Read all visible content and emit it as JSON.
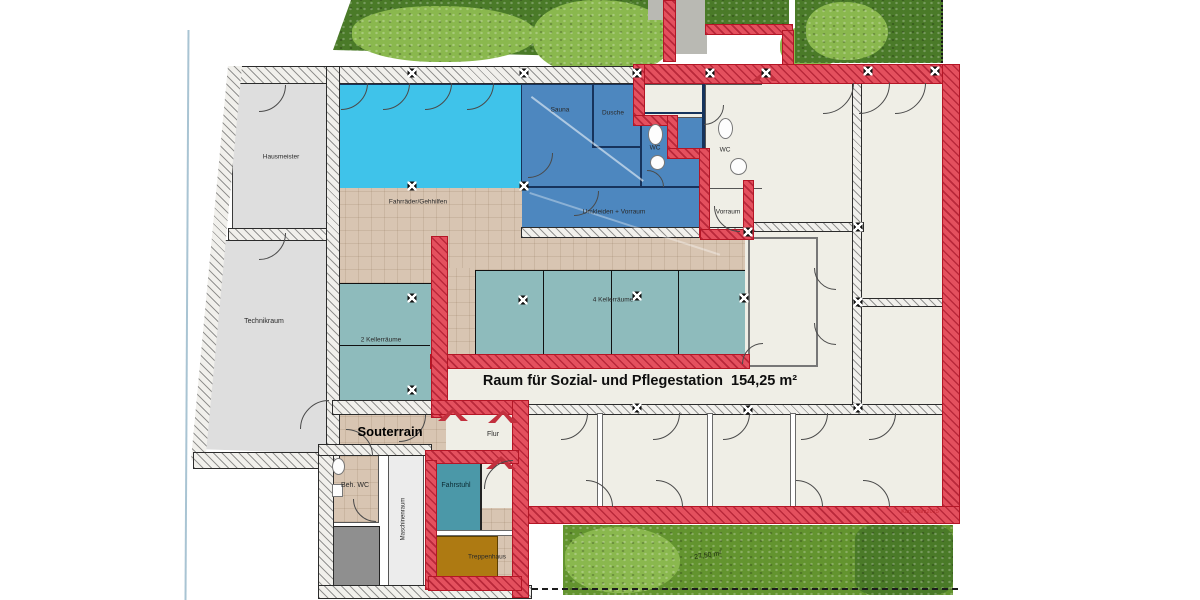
{
  "plan": {
    "type": "architectural-floor-plan",
    "floor": "Souterrain (basement) plan with care-station area highlighted in red",
    "labels": {
      "hausmeister": "Hausmeister",
      "technikraum": "Technikraum",
      "sauna": "Sauna",
      "dusche": "Dusche",
      "wc_left": "WC",
      "wc_right": "WC",
      "umkleiden_vorraum": "Umkleiden + Vorraum",
      "vorraum": "Vorraum",
      "fahrraeder_gehhilfen": "Fahrräder/Gehhilfen",
      "keller2": "2 Kellerräume",
      "keller4": "4 Kellerräume",
      "pflegestation": "Raum für Sozial- und Pflegestation",
      "pflegestation_area": "154,25 m²",
      "souterrain": "Souterrain",
      "flur": "Flur",
      "beh_wc": "Beh. WC",
      "maschinenraum": "Maschinenraum",
      "fahrstuhl": "Fahrstuhl",
      "treppenhaus": "Treppenhaus",
      "hedge_area": "27,50 m²",
      "plan_note": "Kart. März2025"
    },
    "colors": {
      "pool_cyan": "#3fc3ea",
      "room_blue": "#4d87bf",
      "keller_teal": "#8ebbbc",
      "corridor_tan": "#d8c5b2",
      "cream_room": "#efeee6",
      "red_highlight": "#e4505e",
      "stair_brown": "#ae7a12",
      "elevator_teal": "#4b98a8",
      "grey_room": "#dedede"
    }
  }
}
